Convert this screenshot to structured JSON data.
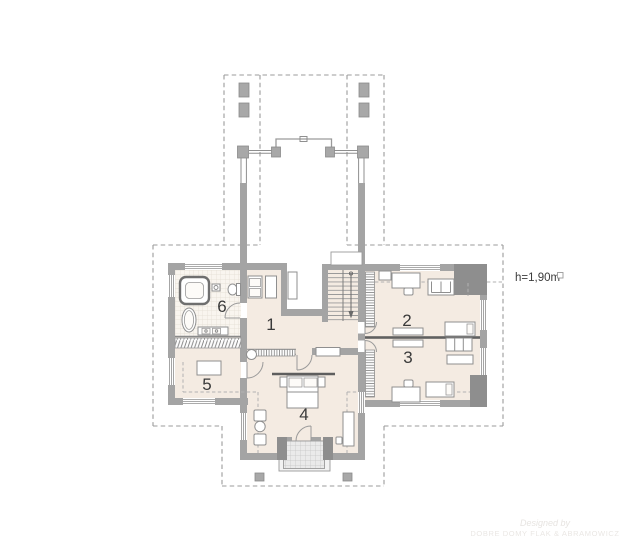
{
  "plan": {
    "rooms": [
      {
        "number": "1"
      },
      {
        "number": "2"
      },
      {
        "number": "3"
      },
      {
        "number": "4"
      },
      {
        "number": "5"
      },
      {
        "number": "6"
      }
    ],
    "height_annotation": "h=1,90m",
    "watermark_line1": "Designed by",
    "watermark_line2": "DOBRE DOMY FLAK & ABRAMOWICZ",
    "colors": {
      "wall": "#a4a4a4",
      "wall_dark": "#8e8e8e",
      "floor": "#f4ebe2",
      "dashed_line": "#9b9b9b",
      "divider_dark": "#5e5e5e",
      "label_text": "#3a3a3a"
    }
  }
}
